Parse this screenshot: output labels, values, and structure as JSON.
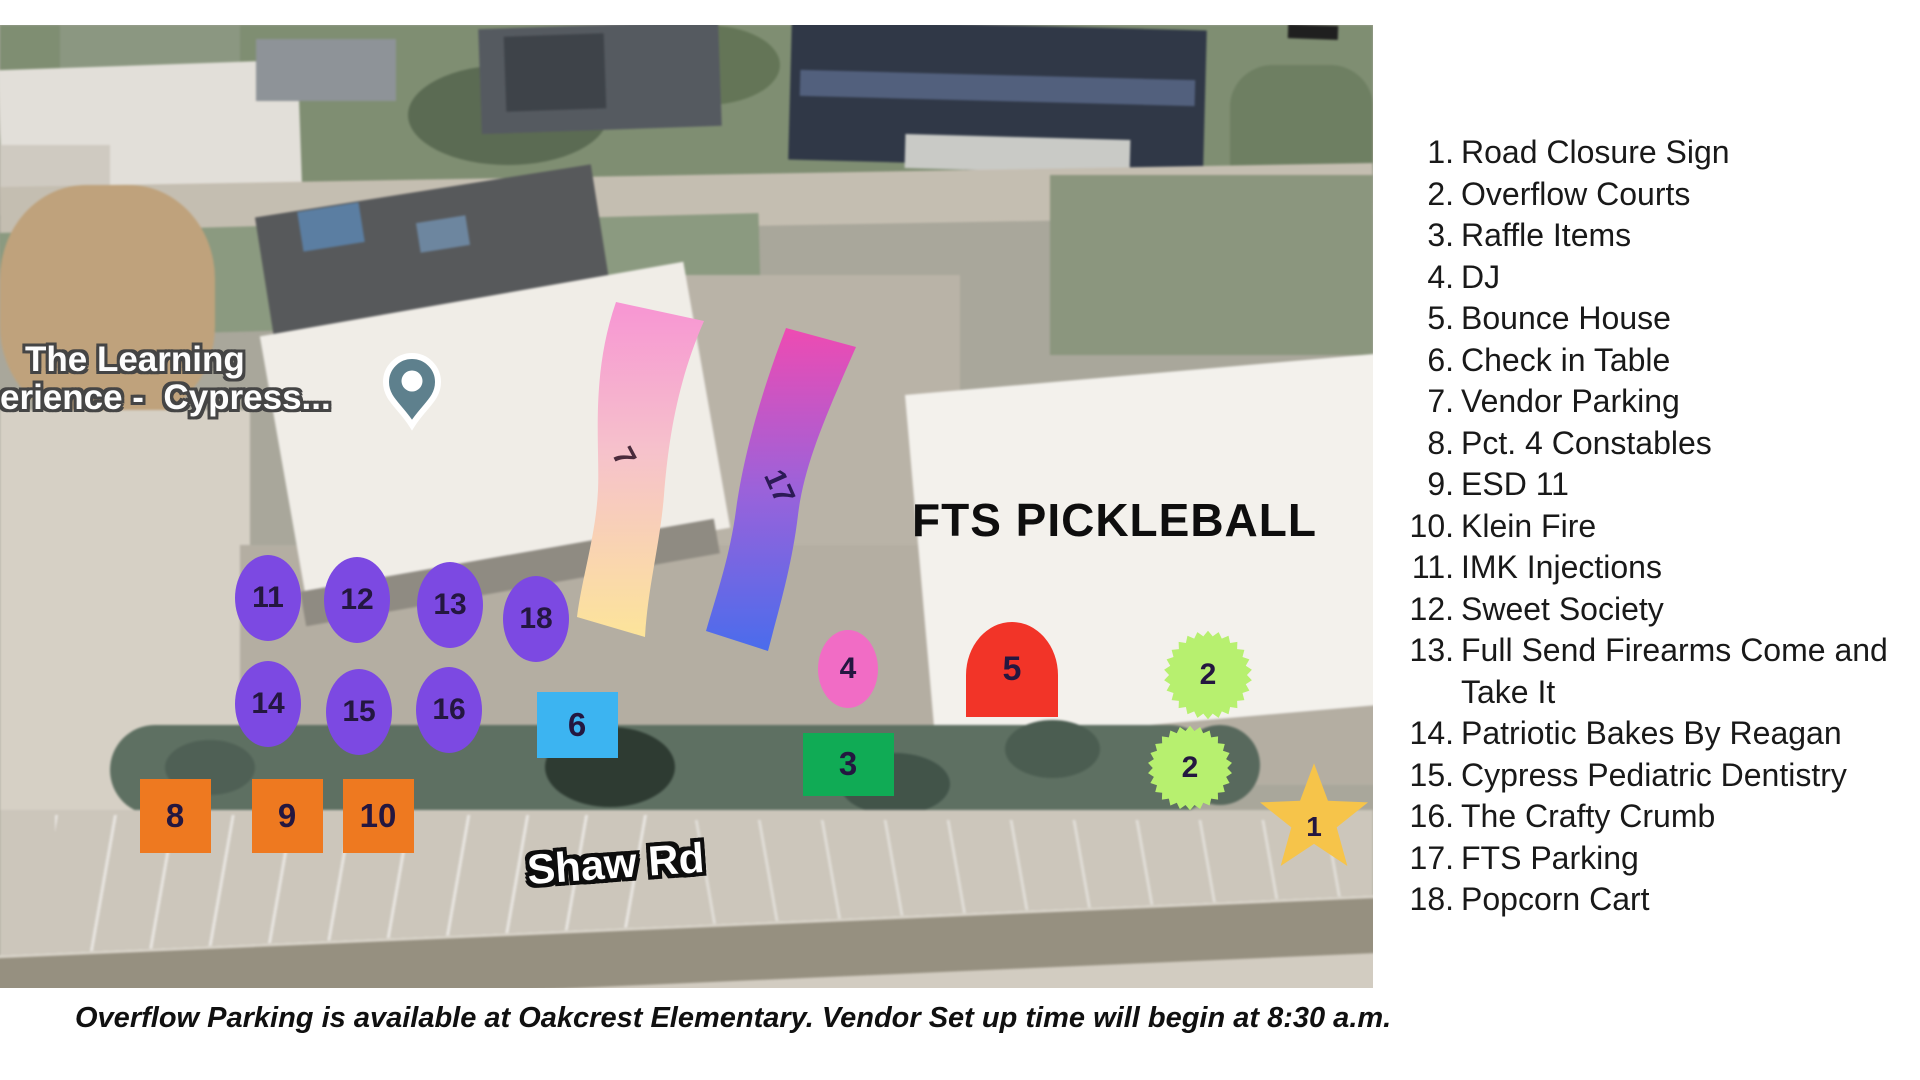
{
  "map": {
    "labels": {
      "place_line1": "The Learning",
      "place_line2": "erience -  Cypress...",
      "venue": "FTS PICKLEBALL",
      "road": "Shaw Rd"
    },
    "pin_color": "#5e808d",
    "markers": [
      {
        "num": "11",
        "shape": "ellipse",
        "color": "#7c49e2",
        "x": 268,
        "y": 573,
        "w": 66,
        "h": 86
      },
      {
        "num": "12",
        "shape": "ellipse",
        "color": "#7c49e2",
        "x": 357,
        "y": 575,
        "w": 66,
        "h": 86
      },
      {
        "num": "13",
        "shape": "ellipse",
        "color": "#7c49e2",
        "x": 450,
        "y": 580,
        "w": 66,
        "h": 86
      },
      {
        "num": "18",
        "shape": "ellipse",
        "color": "#7c49e2",
        "x": 536,
        "y": 594,
        "w": 66,
        "h": 86
      },
      {
        "num": "14",
        "shape": "ellipse",
        "color": "#7c49e2",
        "x": 268,
        "y": 679,
        "w": 66,
        "h": 86
      },
      {
        "num": "15",
        "shape": "ellipse",
        "color": "#7c49e2",
        "x": 359,
        "y": 687,
        "w": 66,
        "h": 86
      },
      {
        "num": "16",
        "shape": "ellipse",
        "color": "#7c49e2",
        "x": 449,
        "y": 685,
        "w": 66,
        "h": 86
      },
      {
        "num": "8",
        "shape": "square",
        "color": "#ee7920",
        "x": 175,
        "y": 791,
        "w": 71,
        "h": 74
      },
      {
        "num": "9",
        "shape": "square",
        "color": "#ee7920",
        "x": 287,
        "y": 791,
        "w": 71,
        "h": 74
      },
      {
        "num": "10",
        "shape": "square",
        "color": "#ee7920",
        "x": 378,
        "y": 791,
        "w": 71,
        "h": 74
      },
      {
        "num": "6",
        "shape": "square",
        "color": "#3cb4f1",
        "x": 577,
        "y": 700,
        "w": 81,
        "h": 66
      },
      {
        "num": "3",
        "shape": "square",
        "color": "#10ab55",
        "x": 848,
        "y": 739,
        "w": 91,
        "h": 63
      },
      {
        "num": "4",
        "shape": "ellipse",
        "color": "#f16cc5",
        "x": 848,
        "y": 644,
        "w": 60,
        "h": 78
      },
      {
        "num": "5",
        "shape": "arch",
        "color": "#f23428",
        "x": 1012,
        "y": 644,
        "w": 92,
        "h": 95
      },
      {
        "num": "2",
        "shape": "scallop",
        "color": "#b7f06f",
        "x": 1208,
        "y": 650,
        "w": 92,
        "h": 92
      },
      {
        "num": "2",
        "shape": "scallop",
        "color": "#b7f06f",
        "x": 1190,
        "y": 743,
        "w": 88,
        "h": 88
      },
      {
        "num": "1",
        "shape": "star",
        "color": "#f6c44a",
        "x": 1314,
        "y": 795,
        "w": 118,
        "h": 118
      }
    ],
    "ribbons": [
      {
        "num": "7",
        "gradient": [
          "#f795d3",
          "#f6c2cb",
          "#fce49a"
        ]
      },
      {
        "num": "17",
        "gradient": [
          "#ee4bb2",
          "#9b62da",
          "#4a6cec"
        ]
      }
    ]
  },
  "legend": {
    "items": [
      {
        "num": "1",
        "label": "Road Closure Sign"
      },
      {
        "num": "2",
        "label": "Overflow Courts"
      },
      {
        "num": "3",
        "label": "Raffle Items"
      },
      {
        "num": "4",
        "label": "DJ"
      },
      {
        "num": "5",
        "label": "Bounce House"
      },
      {
        "num": "6",
        "label": "Check in Table"
      },
      {
        "num": "7",
        "label": "Vendor Parking"
      },
      {
        "num": "8",
        "label": "Pct. 4 Constables"
      },
      {
        "num": "9",
        "label": "ESD 11"
      },
      {
        "num": "10",
        "label": "Klein Fire"
      },
      {
        "num": "11",
        "label": "IMK Injections"
      },
      {
        "num": "12",
        "label": "Sweet Society"
      },
      {
        "num": "13",
        "label": "Full Send Firearms Come and Take It"
      },
      {
        "num": "14",
        "label": "Patriotic Bakes By Reagan"
      },
      {
        "num": "15",
        "label": "Cypress Pediatric Dentistry"
      },
      {
        "num": "16",
        "label": "The Crafty Crumb"
      },
      {
        "num": "17",
        "label": "FTS Parking"
      },
      {
        "num": "18",
        "label": "Popcorn Cart"
      }
    ]
  },
  "footer": {
    "note": "Overflow Parking is available at Oakcrest Elementary. Vendor Set up time will begin at 8:30 a.m."
  }
}
